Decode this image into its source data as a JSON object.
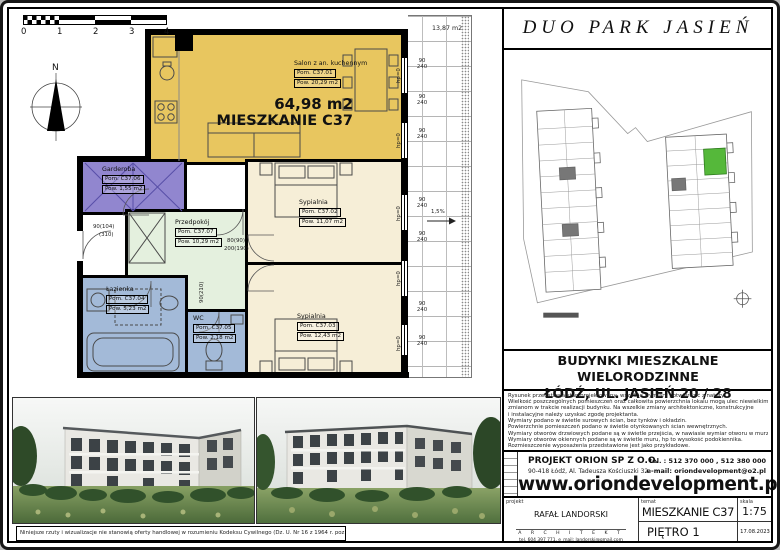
{
  "plan": {
    "scale_ticks": [
      "0",
      "1",
      "2",
      "3",
      "4"
    ],
    "north_label": "N",
    "total_area": "64,98 m2",
    "unit_name": "MIESZKANIE C37",
    "balcony_area": "13,87 m2",
    "slope": "1,5%",
    "window_width": "90",
    "window_height": "240",
    "hp_label": "hp=0",
    "door_labels": {
      "d1": "90(104)",
      "d2": "(310)",
      "d3": "80(90)",
      "d4": "200(190)",
      "d5": "90(210)"
    },
    "rooms": [
      {
        "name": "Salon z an. kuchennym",
        "id": "Pom. C37.01",
        "area": "Pow. 20,29 m2"
      },
      {
        "name": "Sypialnia",
        "id": "Pom. C37.02",
        "area": "Pow. 11,07 m2"
      },
      {
        "name": "Sypialnia",
        "id": "Pom. C37.03",
        "area": "Pow. 12,43 m2"
      },
      {
        "name": "Łazienka",
        "id": "Pom. C37.04",
        "area": "Pow. 5,23 m2"
      },
      {
        "name": "WC",
        "id": "Pom. C37.05",
        "area": "Pow. 2,18 m2"
      },
      {
        "name": "Garderoba",
        "id": "Pom. C37.06",
        "area": "Pow. 1,55 m2"
      },
      {
        "name": "Przedpokój",
        "id": "Pom. C37.07",
        "area": "Pow. 10,29 m2"
      }
    ],
    "colors": {
      "salon": "#e8c65f",
      "bedroom": "#f6eed7",
      "wardrobe": "#9186cf",
      "hall": "#e4f0de",
      "bath": "#a3bad8",
      "site_highlight": "#55b83a"
    }
  },
  "titleblock": {
    "project_title": "DUO PARK JASIEŃ",
    "building_line1": "BUDYNKI MIESZKALNE WIELORODZINNE",
    "building_line2": "ŁÓDŹ, UL. JASIEŃ 20 / 28",
    "notes": [
      "Rysunek przedstawia stan projektowany, wszelkie wymiary potwierdzić z natury.",
      "Wielkość poszczególnych pomieszczeń oraz całkowita powierzchnia lokalu mogą ulec niewielkim",
      "zmianom w trakcie realizacji budynku. Na wszelkie zmiany architektoniczne, konstrukcyjne",
      "i instalacyjne należy uzyskać zgodę projektanta.",
      "Wymiary podano w świetle surowych ścian, bez tynków i okładzin.",
      "Powierzchnie pomieszczeń podano w świetle otynkowanych ścian wewnętrznych.",
      "Wymiary otworów drzwiowych podane są w świetle przejścia, w nawiasie wymiar otworu w murze.",
      "Wymiary otworów okiennych podane są w świetle muru, hp to wysokość podokiennika.",
      "Rozmieszczenie wyposażenia przedstawione jest jako przykładowe."
    ],
    "company_name": "PROJEKT ORION SP Z O.O.",
    "company_address": "90-418 Łódź, Al. Tadeusza Kościuszki 32",
    "company_tel": "tel. : 512 370 000 , 512 380 000",
    "company_email": "e-mail: oriondevelopment@o2.pl",
    "website": "www.oriondevelopment.pl",
    "label_projekt": "projekt",
    "label_temat": "temat",
    "label_skala": "skala",
    "architect_name": "RAFAŁ LANDORSKI",
    "architect_title": "A R C H I T E K T",
    "architect_contact": "tel. 604 397 771,      e_mail: landorski@gmail.com",
    "subject": "MIESZKANIE  C37",
    "scale_value": "1:75",
    "floor": "PIĘTRO 1",
    "date": "17.08.2023"
  },
  "disclaimer": "Niniejsze rzuty i wizualizacje nie stanowią oferty handlowej w rozumieniu Kodeksu Cywilnego (Dz. U. Nr 16 z 1964 r. poz. 93 z późn. zm.)"
}
